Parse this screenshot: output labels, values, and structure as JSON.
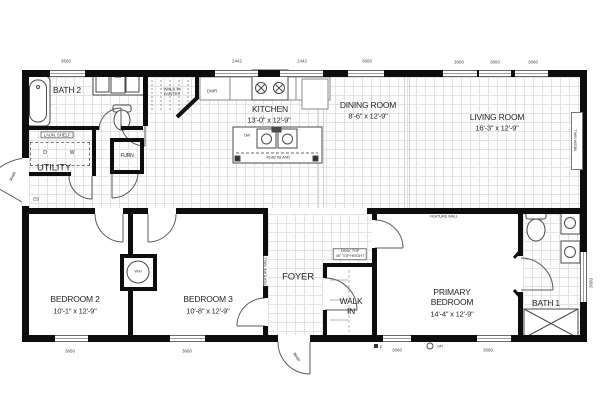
{
  "plan": {
    "rooms": {
      "bath2": {
        "name": "BATH 2"
      },
      "laun_shelf": "LAUN. SHELF",
      "dryer": "D",
      "washer": "W",
      "utility": {
        "name": "UTILITY"
      },
      "furn": "FURN",
      "pantry": "WALK IN\nPANTRY",
      "dwr": "DWR",
      "kitchen": {
        "name": "KITCHEN",
        "dims": "13'-0\" x 12'-9\""
      },
      "dw": "DW",
      "island": "42x82 ISLAND",
      "dining": {
        "name": "DINING ROOM",
        "dims": "8'-6\" x 12'-9\""
      },
      "living": {
        "name": "LIVING ROOM",
        "dims": "16'-3\" x 12'-9\""
      },
      "media_wall": "MEDIA WALL",
      "bedroom2": {
        "name": "BEDROOM 2",
        "dims": "10'-1\" x 12'-9\""
      },
      "bedroom3": {
        "name": "BEDROOM 3",
        "dims": "10'-8\" x 12'-9\""
      },
      "wh": "W/H",
      "feature_wall_foyer": "FEATURE WALL",
      "feature_wall_primary": "FEATURE WALL",
      "foyer": {
        "name": "FOYER"
      },
      "desk": "DESK TOP\n36\" TOP HEIGHT",
      "walkin": "WALK\nIN",
      "primary": {
        "name": "PRIMARY\nBEDROOM",
        "dims": "14'-4\" x 12'-9\""
      },
      "bath1": {
        "name": "BATH 1"
      }
    },
    "dims_top": [
      "3660",
      "2442",
      "2442",
      "3660",
      "3660",
      "3660",
      "3660"
    ],
    "dims_bottom": [
      "3660",
      "3660",
      "3660",
      "3660"
    ],
    "dim_right": "3660",
    "door_labels": {
      "left": "36x80",
      "front": "36x80"
    },
    "annotations": {
      "es": "ES",
      "f": "F",
      "gfi": "GFI"
    }
  }
}
